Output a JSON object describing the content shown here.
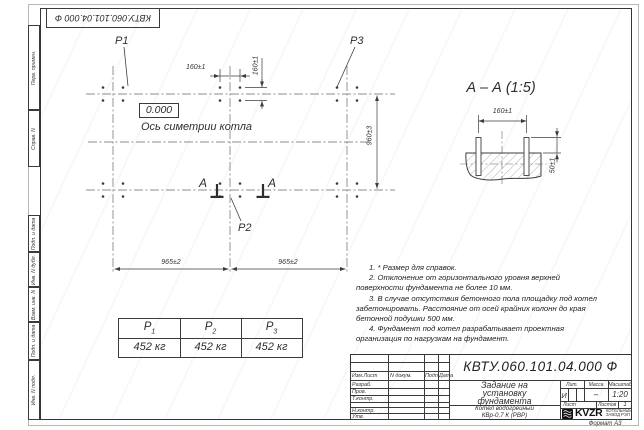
{
  "corner_stamp": {
    "text": "КВТУ.060.101.04.000 Ф"
  },
  "side_labels": {
    "perv": "Перв. примен.",
    "sprav": "Справ. N",
    "podp1": "Подп. и дата",
    "inv_dubl": "Инв. N дубл.",
    "vzam": "Взам. инв. N",
    "podp2": "Подп. и дата",
    "inv_podl": "Инв. N подл."
  },
  "plan": {
    "p1": "P1",
    "p2": "P2",
    "p3": "P3",
    "level": "0.000",
    "axis_label": "Ось симетрии котла",
    "section_letter_left": "А",
    "section_letter_right": "А",
    "dim_160_h": "160±1",
    "dim_160_v": "160±1",
    "dim_960": "960±3",
    "dim_965_left": "965±2",
    "dim_965_right": "965±2"
  },
  "section_view": {
    "title": "А – А (1:5)",
    "dim_160": "160±1",
    "dim_50": "50±1"
  },
  "loads_table": {
    "headers": [
      {
        "base": "P",
        "sub": "1"
      },
      {
        "base": "P",
        "sub": "2"
      },
      {
        "base": "P",
        "sub": "3"
      }
    ],
    "values": [
      "452 кг",
      "452 кг",
      "452 кг"
    ]
  },
  "notes": [
    "1. * Размер для справок.",
    "2. Отклонение от горизонтального уровня верхней поверхности фундамента не более 10 мм.",
    "3. В случае отсутствия бетонного пола площадку под котел забетонировать. Расстояние от осей крайних колонн до края бетонной подушки 500 мм.",
    "4. Фундамент под котел разрабатывает проектная организация по нагрузкам на фундамент."
  ],
  "title_block": {
    "doc_number": "КВТУ.060.101.04.000 Ф",
    "title_lines": [
      "Задание на",
      "установку",
      "фундамента"
    ],
    "product_lines": [
      "Котел водогрейный",
      "КВр-0,7 К  (РВР)"
    ],
    "header_cols": [
      "Изм.Лист",
      "N докум.",
      "Подп.",
      "Дата"
    ],
    "sign_rows": [
      "Разраб.",
      "Пров.",
      "Т.контр.",
      "",
      "Н.контр.",
      "Утв."
    ],
    "lit_label": "Лит.",
    "mass_label": "Масса",
    "scale_label": "Масштаб",
    "lit_value": "И",
    "mass_value": "–",
    "scale_value": "1:20",
    "sheet_label": "Лист",
    "sheets_label": "Листов",
    "sheets_value": "1",
    "company": {
      "logo": "KVZR",
      "sub1": "КОТЕЛЬНЫЙ",
      "sub2": "ЗАВОД РЭП"
    },
    "format_note": "Формат А3"
  },
  "colors": {
    "line": "#3d3d3d",
    "paper": "#ffffff"
  }
}
